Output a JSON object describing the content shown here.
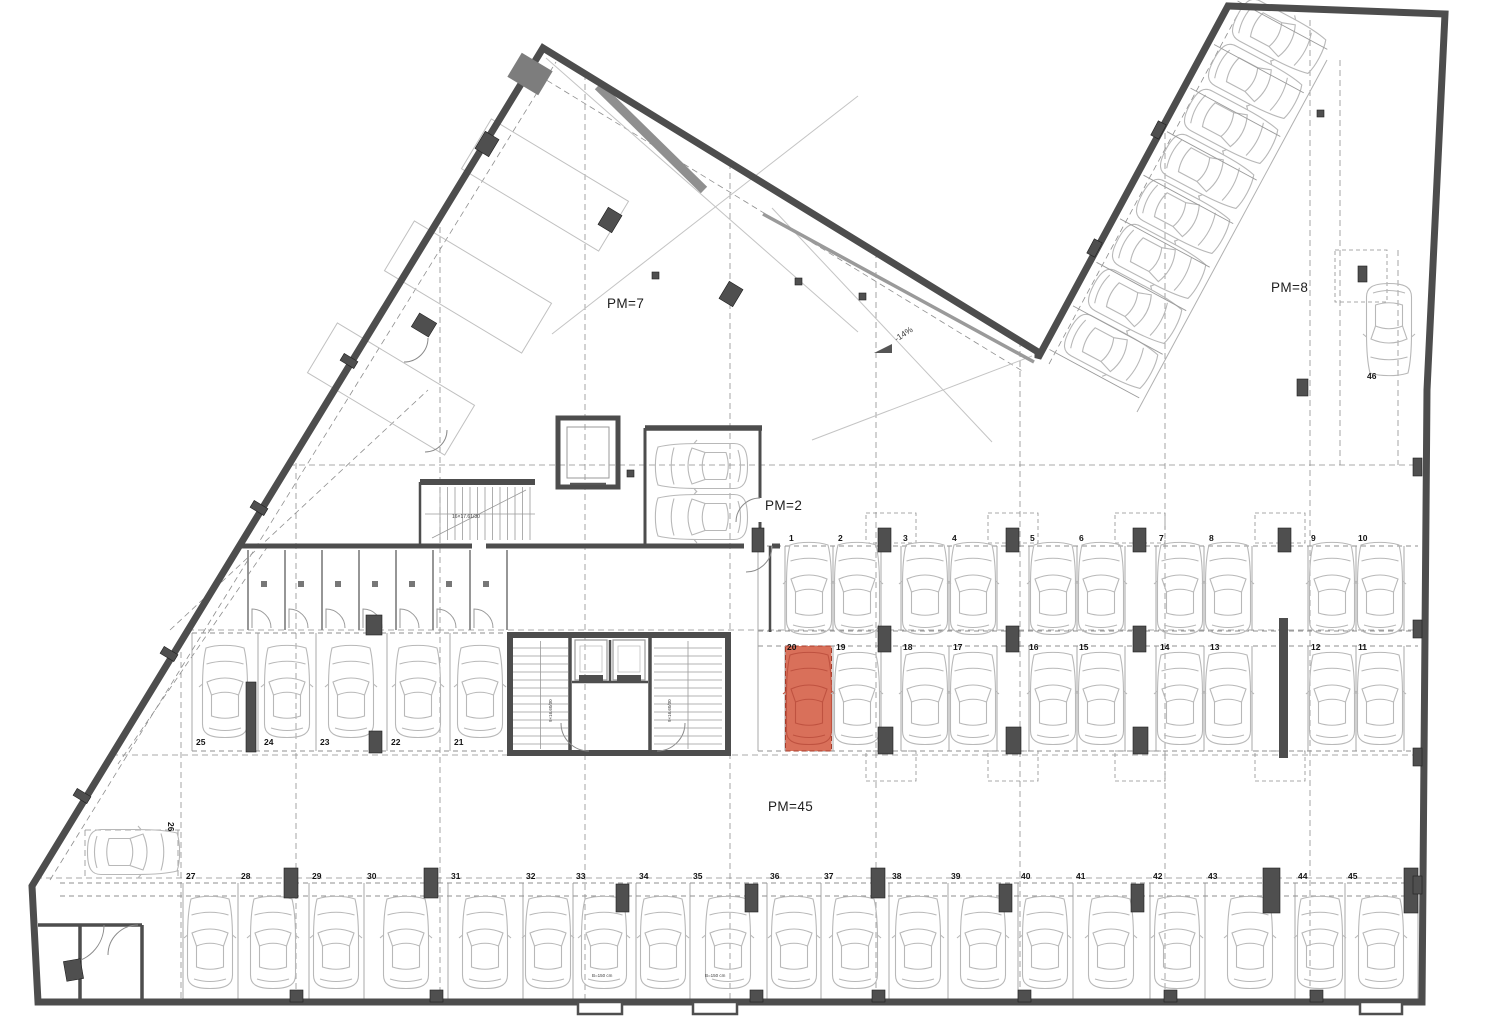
{
  "plan": {
    "title": "Underground parking floor plan",
    "highlight_color": "#d9705a",
    "highlighted_space": "20",
    "zones": {
      "pm7": {
        "label": "PM=7"
      },
      "pm8": {
        "label": "PM=8"
      },
      "pm2": {
        "label": "PM=2"
      },
      "pm45": {
        "label": "PM=45"
      }
    },
    "ramp": {
      "slope_label": "-14%"
    },
    "parking_spaces": [
      {
        "n": "1",
        "x": 789,
        "y": 534
      },
      {
        "n": "2",
        "x": 838,
        "y": 534
      },
      {
        "n": "3",
        "x": 903,
        "y": 534
      },
      {
        "n": "4",
        "x": 952,
        "y": 534
      },
      {
        "n": "5",
        "x": 1030,
        "y": 534
      },
      {
        "n": "6",
        "x": 1079,
        "y": 534
      },
      {
        "n": "7",
        "x": 1159,
        "y": 534
      },
      {
        "n": "8",
        "x": 1209,
        "y": 534
      },
      {
        "n": "9",
        "x": 1311,
        "y": 534
      },
      {
        "n": "10",
        "x": 1358,
        "y": 534
      },
      {
        "n": "20",
        "x": 787,
        "y": 643
      },
      {
        "n": "19",
        "x": 836,
        "y": 643
      },
      {
        "n": "18",
        "x": 903,
        "y": 643
      },
      {
        "n": "17",
        "x": 953,
        "y": 643
      },
      {
        "n": "16",
        "x": 1029,
        "y": 643
      },
      {
        "n": "15",
        "x": 1079,
        "y": 643
      },
      {
        "n": "14",
        "x": 1160,
        "y": 643
      },
      {
        "n": "13",
        "x": 1210,
        "y": 643
      },
      {
        "n": "12",
        "x": 1311,
        "y": 643
      },
      {
        "n": "11",
        "x": 1358,
        "y": 643
      },
      {
        "n": "25",
        "x": 196,
        "y": 738
      },
      {
        "n": "24",
        "x": 264,
        "y": 738
      },
      {
        "n": "23",
        "x": 320,
        "y": 738
      },
      {
        "n": "22",
        "x": 391,
        "y": 738
      },
      {
        "n": "21",
        "x": 454,
        "y": 738
      },
      {
        "n": "26",
        "x": 175,
        "y": 822,
        "rot": 90
      },
      {
        "n": "27",
        "x": 186,
        "y": 872
      },
      {
        "n": "28",
        "x": 241,
        "y": 872
      },
      {
        "n": "29",
        "x": 312,
        "y": 872
      },
      {
        "n": "30",
        "x": 367,
        "y": 872
      },
      {
        "n": "31",
        "x": 451,
        "y": 872
      },
      {
        "n": "32",
        "x": 526,
        "y": 872
      },
      {
        "n": "33",
        "x": 576,
        "y": 872
      },
      {
        "n": "34",
        "x": 639,
        "y": 872
      },
      {
        "n": "35",
        "x": 693,
        "y": 872
      },
      {
        "n": "36",
        "x": 770,
        "y": 872
      },
      {
        "n": "37",
        "x": 824,
        "y": 872
      },
      {
        "n": "38",
        "x": 892,
        "y": 872
      },
      {
        "n": "39",
        "x": 951,
        "y": 872
      },
      {
        "n": "40",
        "x": 1021,
        "y": 872
      },
      {
        "n": "41",
        "x": 1076,
        "y": 872
      },
      {
        "n": "42",
        "x": 1153,
        "y": 872
      },
      {
        "n": "43",
        "x": 1208,
        "y": 872
      },
      {
        "n": "44",
        "x": 1298,
        "y": 872
      },
      {
        "n": "45",
        "x": 1348,
        "y": 872
      },
      {
        "n": "46",
        "x": 1367,
        "y": 372
      }
    ],
    "notes": [
      {
        "text": "-14%",
        "x": 893,
        "y": 336,
        "size": 8.5,
        "rot": -33
      },
      {
        "text": "16×17.61/30",
        "x": 452,
        "y": 515,
        "size": 5,
        "rot": 0
      },
      {
        "text": "9×16.60/30",
        "x": 549,
        "y": 722,
        "size": 4.5,
        "rot": -90
      },
      {
        "text": "9×16.60/30",
        "x": 668,
        "y": 722,
        "size": 4.5,
        "rot": -90
      },
      {
        "text": "B=150 cm",
        "x": 592,
        "y": 974,
        "size": 4.5,
        "rot": 0
      },
      {
        "text": "B=150 cm",
        "x": 705,
        "y": 974,
        "size": 4.5,
        "rot": 0
      }
    ]
  }
}
